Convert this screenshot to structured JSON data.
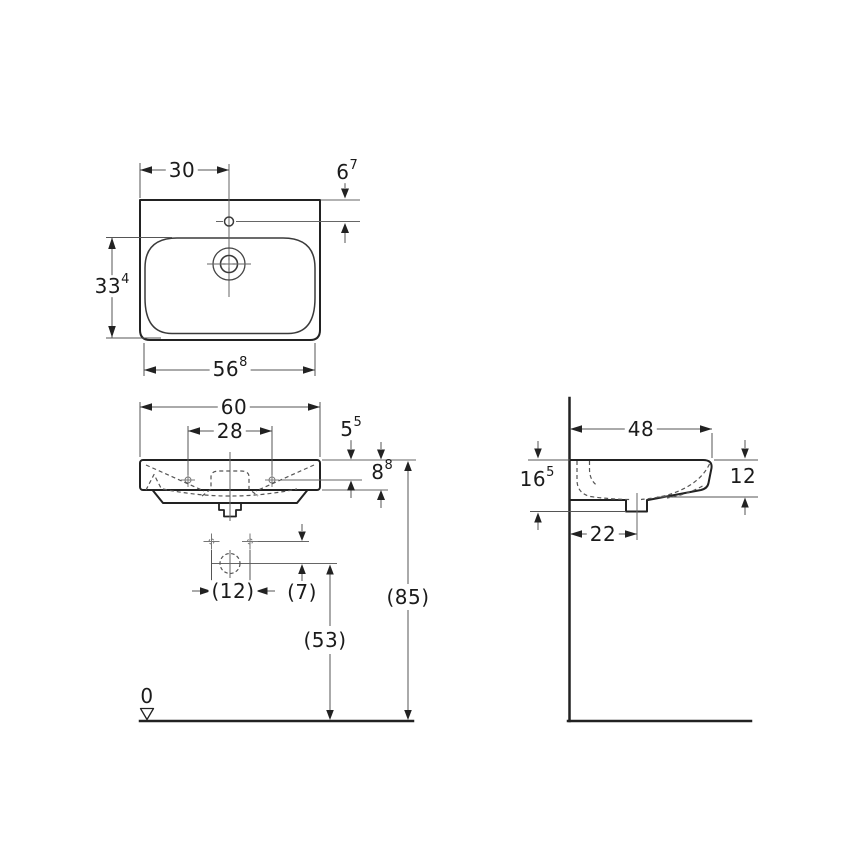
{
  "drawing": {
    "type": "washbasin technical drawing",
    "views": {
      "top": "top view",
      "front": "front view",
      "side": "side view"
    },
    "line_colors": {
      "object": "#222222",
      "dimension": "#555555",
      "text": "#1b1b1b"
    }
  },
  "dimensions": {
    "top_view": {
      "tap_from_left": {
        "value": "30",
        "sup": ""
      },
      "tap_from_back": {
        "value": "6",
        "sup": "7"
      },
      "bowl_depth": {
        "value": "33",
        "sup": "4"
      },
      "front_width": {
        "value": "56",
        "sup": "8"
      }
    },
    "front_view": {
      "total_width": {
        "value": "60",
        "sup": ""
      },
      "fixing_hole_gap": {
        "value": "28",
        "sup": ""
      },
      "rim_to_hole": {
        "value": "5",
        "sup": "5"
      },
      "rim_height": {
        "value": "8",
        "sup": "8"
      },
      "drain_offset": {
        "value": "(12)",
        "sup": ""
      },
      "hole_to_drain": {
        "value": "(7)",
        "sup": ""
      },
      "drain_from_floor": {
        "value": "(53)",
        "sup": ""
      },
      "rim_from_floor": {
        "value": "(85)",
        "sup": ""
      },
      "floor_datum": {
        "value": "0",
        "sup": ""
      }
    },
    "side_view": {
      "total_depth": {
        "value": "48",
        "sup": ""
      },
      "ceramic_height": {
        "value": "16",
        "sup": "5"
      },
      "front_edge_height": {
        "value": "12",
        "sup": ""
      },
      "drain_from_wall": {
        "value": "22",
        "sup": ""
      }
    }
  }
}
